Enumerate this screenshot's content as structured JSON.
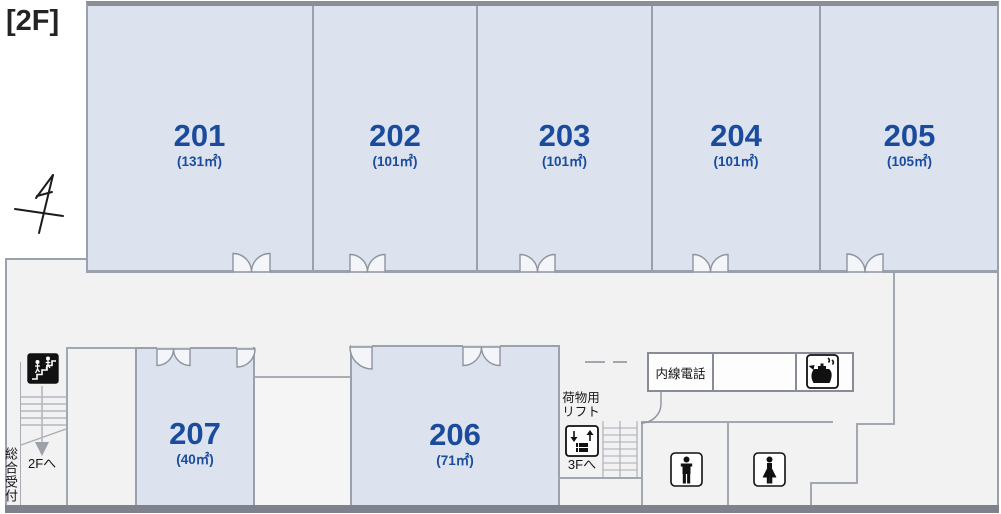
{
  "floor_label": "[2F]",
  "rooms": [
    {
      "number": "201",
      "area": "(131㎡)"
    },
    {
      "number": "202",
      "area": "(101㎡)"
    },
    {
      "number": "203",
      "area": "(101㎡)"
    },
    {
      "number": "204",
      "area": "(101㎡)"
    },
    {
      "number": "205",
      "area": "(105㎡)"
    },
    {
      "number": "206",
      "area": "(71㎡)"
    },
    {
      "number": "207",
      "area": "(40㎡)"
    }
  ],
  "labels": {
    "reception": "総合受付",
    "to_2f": "2Fへ",
    "to_3f": "3Fへ",
    "cargo_lift_line1": "荷物用",
    "cargo_lift_line2": "リフト",
    "extension_phone": "内線電話"
  },
  "icons": {
    "stairs": "stairs-icon",
    "cargo_lift": "cargo-lift-icon",
    "kettle": "kettle-icon",
    "mens_restroom": "mens-restroom-icon",
    "womens_restroom": "womens-restroom-icon",
    "compass": "north-arrow-icon"
  },
  "colors": {
    "room_fill": "#dce2ee",
    "room_text": "#1a4b9d",
    "wall": "#9aa1ac",
    "corridor_fill": "#f2f2f3",
    "frame_dark": "#7d828c"
  }
}
